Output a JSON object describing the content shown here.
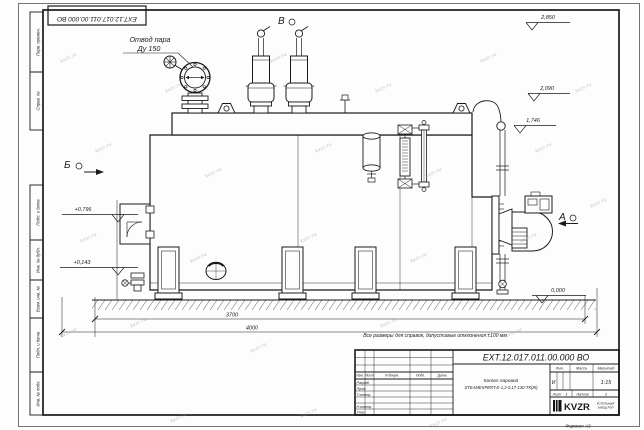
{
  "watermark": "kvzr.ru",
  "frame": {
    "top_stamp": "EXT.12.017.011.00.000 ВО",
    "left_labels_top": [
      "Перв. примен.",
      "Справ. №"
    ],
    "left_labels_bottom": [
      "Подп. и дата",
      "Инв. № дубл.",
      "Взам. инв. №",
      "Подп. и дата",
      "Инв. № подл."
    ],
    "format_label": "Формат А3"
  },
  "drawing": {
    "callout": {
      "line1": "Отвод пара",
      "line2": "Ду 150"
    },
    "views": {
      "a": "А",
      "b": "Б",
      "v": "В"
    },
    "elevations": [
      "2,850",
      "2,090",
      "1,746",
      "+0,796",
      "+0,143",
      "0,000"
    ],
    "dimensions": [
      "3700",
      "4000"
    ],
    "note": "Все размеры для справок, допустимые отклонения ±100 мм"
  },
  "title_block": {
    "doc_number": "EXT.12.017.011.00.000 ВО",
    "product_name_line1": "Котел паровой",
    "product_name_line2": "STEAMEXPERT-Е-1,2-0,17-130-ТК(Ж)",
    "col_headers": [
      "Изм.",
      "Лист",
      "N докум.",
      "Подп.",
      "Дата"
    ],
    "row_labels": [
      "Разраб.",
      "Пров.",
      "Т.контр.",
      "Н.контр.",
      "Утв."
    ],
    "lit_header": "Лит.",
    "mass_header": "Масса",
    "scale_header": "Масштаб",
    "lit_value": "И",
    "scale_value": "1:15",
    "sheet_label": "Лист",
    "sheet_value": "1",
    "sheets_label": "Листов",
    "sheets_value": "2",
    "logo_text": "KVZR",
    "logo_sub1": "КОТЕЛЬНЫЙ",
    "logo_sub2": "ЗАВОД РЭП"
  }
}
